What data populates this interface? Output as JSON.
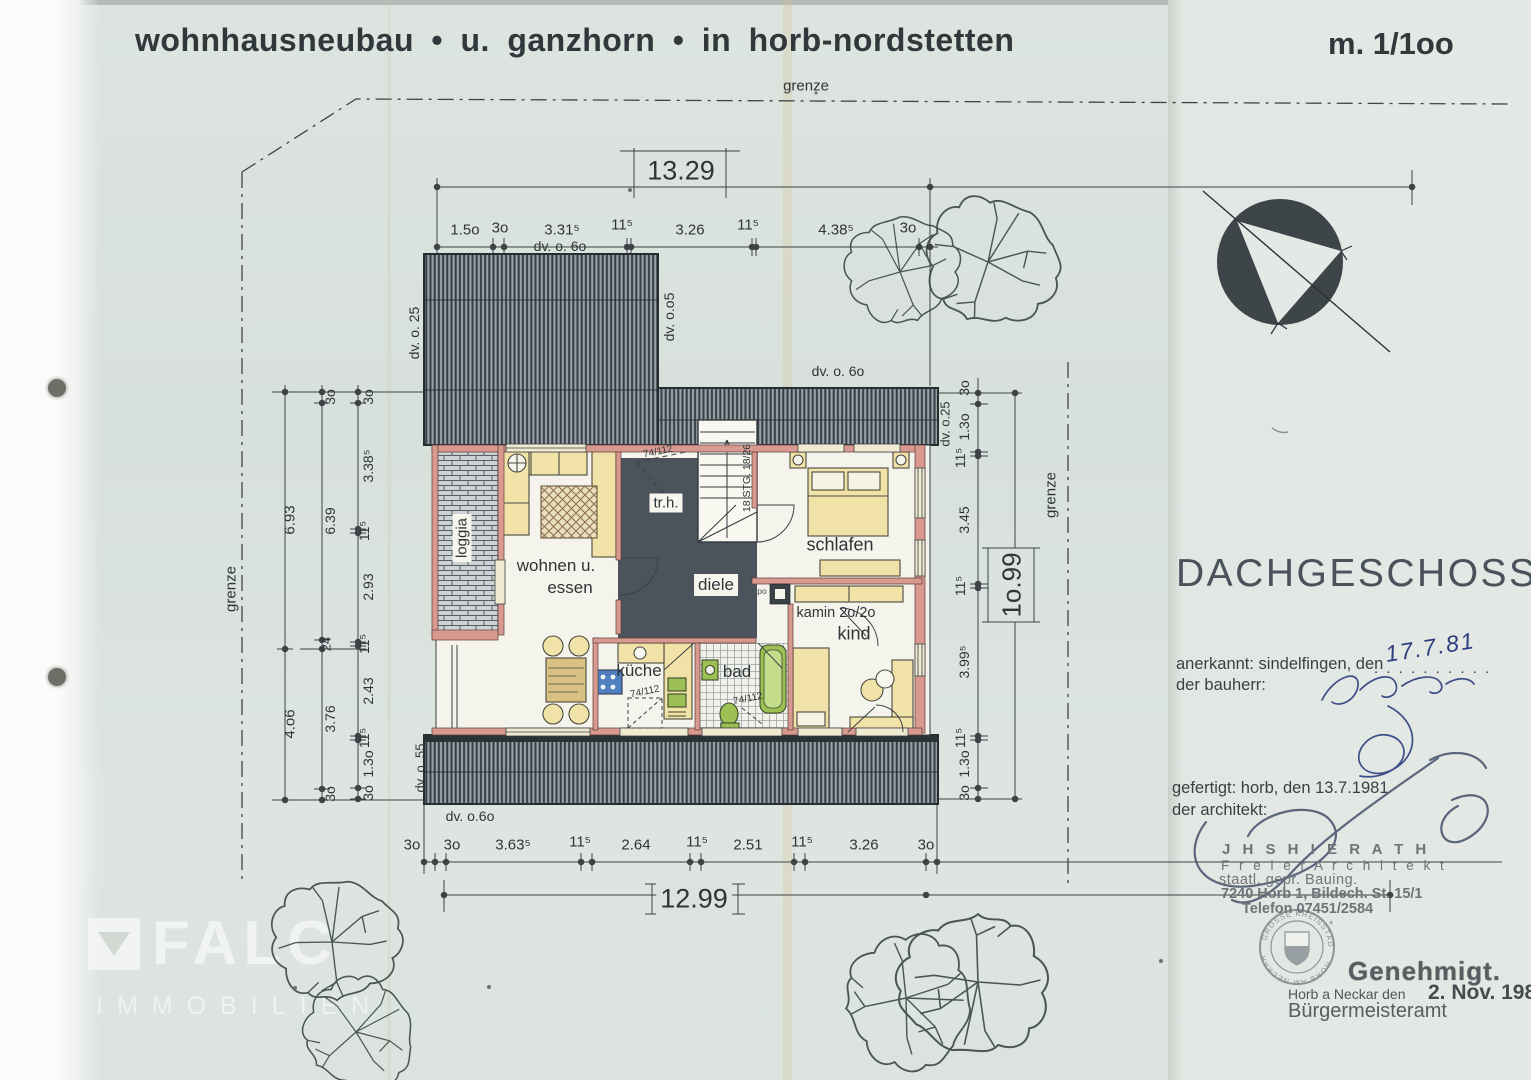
{
  "header": {
    "project_title": "wohnhausneubau • u. ganzhorn • in horb-nordstetten",
    "scale": "m. 1/1oo"
  },
  "floor": {
    "name": "DACHGESCHOSS"
  },
  "boundary": {
    "top_label": "grenze",
    "left_label": "grenze",
    "right_label": "grenze"
  },
  "rooms": {
    "loggia": "loggia",
    "wohnen_line1": "wohnen u.",
    "wohnen_line2": "essen",
    "trh": "tr.h.",
    "diele": "diele",
    "schlafen": "schlafen",
    "kind": "kind",
    "kueche": "küche",
    "bad": "bad"
  },
  "annotations": {
    "stairs": "18 STG. 18/26",
    "kamin": "kamin 2o/2o",
    "po": "po",
    "win_stairs": "74/112",
    "win_kueche": "74/112",
    "win_bad": "74/112"
  },
  "roof_labels": {
    "top_left": "dv. o. 6o",
    "left": "dv. o. 25",
    "step": "dv. o.o5",
    "band": "dv. o. 6o",
    "right": "dv. o.25",
    "bottom_left": "dv. o. 55",
    "bottom": "dv. o.6o"
  },
  "dimensions": {
    "top_total": "13.29",
    "top_chain": [
      "1.5o",
      "3o",
      "3.31⁵",
      "11⁵",
      "3.26",
      "11⁵",
      "4.38⁵",
      "3o"
    ],
    "bottom_total": "12.99",
    "bottom_chain": [
      "3o",
      "3o",
      "3.63⁵",
      "11⁵",
      "2.64",
      "11⁵",
      "2.51",
      "11⁵",
      "3.26",
      "3o"
    ],
    "right_total": "1o.99",
    "right_chain": [
      "3o",
      "1.3o",
      "11⁵",
      "3.45",
      "11⁵",
      "3.99⁵",
      "11⁵",
      "1.3o",
      "3o"
    ],
    "left_inner": [
      "3o",
      "3.38⁵",
      "11⁵",
      "2.93",
      "11⁵",
      "2.43",
      "11⁵",
      "1.3o",
      "3o"
    ],
    "left_mid": [
      "3o",
      "6.39",
      "24",
      "3.76",
      "3o"
    ],
    "left_outer": [
      "6.93",
      "4.o6"
    ]
  },
  "approval": {
    "anerkannt_label": "anerkannt: sindelfingen, den",
    "anerkannt_dots": ". . . . . . . . . .",
    "anerkannt_date": "17.7.81",
    "bauherr_label": "der bauherr:",
    "gefertigt_label": "gefertigt: horb, den 13.7.1981",
    "architekt_label": "der architekt:",
    "stamp_name": "J H S   H I E R A T H",
    "stamp_title": "F r e i e r   A r c h i t e k t",
    "stamp_qual": "staatl. gepr. Bauing.",
    "stamp_addr": "7240 Horb 1, Bildech. St. 15/1",
    "stamp_tel": "Telefon 07451/2584",
    "seal_top": "GROSSE KREISSTADT",
    "seal_bottom": "HORB AM NECKAR",
    "seal_star": "*",
    "approved": "Genehmigt.",
    "approved_place": "Horb a Neckar den",
    "approved_date": "2. Nov. 1981",
    "approved_office": "Bürgermeisteramt"
  },
  "watermark": {
    "brand": "FALC",
    "suffix": "IMMOBILIEN"
  },
  "colors": {
    "paper": "#dce3df",
    "ink": "#2f363a",
    "wall_pink": "#d69890",
    "roof_dark": "#39424a",
    "furniture_yellow": "#f1e2a8",
    "fixture_green": "#9cc053",
    "stove_blue": "#4f80bf",
    "handwriting_blue": "#31418c",
    "stamp_gray": "#6d7377"
  }
}
